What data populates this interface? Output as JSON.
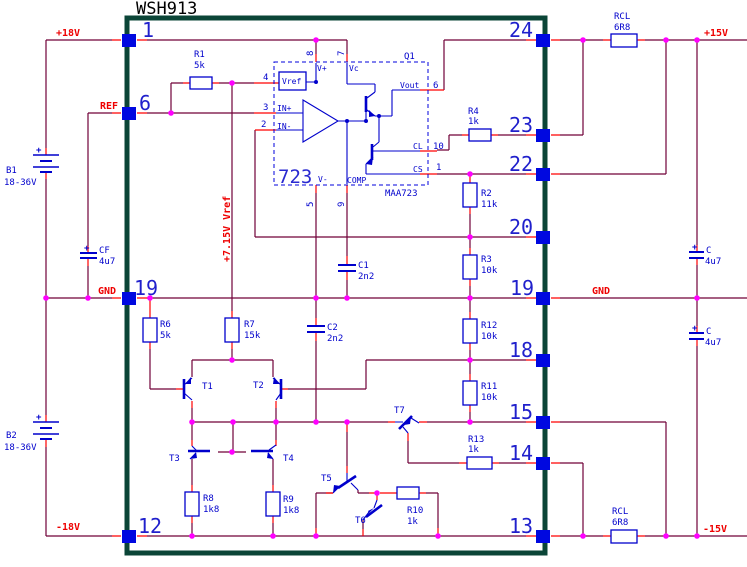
{
  "title": "WSH913",
  "module": {
    "pins_left": [
      "1",
      "6",
      "19",
      "12"
    ],
    "pins_right": [
      "24",
      "23",
      "22",
      "20",
      "19",
      "18",
      "15",
      "14",
      "13"
    ]
  },
  "power": {
    "p18": "+18V",
    "m18": "-18V",
    "p15": "+15V",
    "m15": "-15V",
    "gnd_left": "GND",
    "gnd_right": "GND",
    "ref": "REF",
    "vref_rail": "+7.15V Vref"
  },
  "sources": {
    "b1": {
      "name": "B1",
      "value": "18-36V",
      "plus": "+"
    },
    "b2": {
      "name": "B2",
      "value": "18-36V",
      "plus": "+"
    }
  },
  "ic": {
    "big": "723",
    "part": "MAA723",
    "designator": "Q1",
    "vref_block": "Vref",
    "names": {
      "vplus": "V+",
      "vc": "Vc",
      "vout": "Vout",
      "cl": "CL",
      "cs": "CS",
      "vminus": "V-",
      "comp": "COMP",
      "inplus": "IN+",
      "inminus": "IN-"
    },
    "numbers": {
      "n8": "8",
      "n7": "7",
      "n4": "4",
      "n3": "3",
      "n2": "2",
      "n6": "6",
      "n10": "10",
      "n1": "1",
      "n5": "5",
      "n9": "9"
    }
  },
  "resistors": {
    "r1": {
      "name": "R1",
      "value": "5k"
    },
    "r2": {
      "name": "R2",
      "value": "11k"
    },
    "r3": {
      "name": "R3",
      "value": "10k"
    },
    "r4": {
      "name": "R4",
      "value": "1k"
    },
    "r6": {
      "name": "R6",
      "value": "5k"
    },
    "r7": {
      "name": "R7",
      "value": "15k"
    },
    "r8": {
      "name": "R8",
      "value": "1k8"
    },
    "r9": {
      "name": "R9",
      "value": "1k8"
    },
    "r10": {
      "name": "R10",
      "value": "1k"
    },
    "r11": {
      "name": "R11",
      "value": "10k"
    },
    "r12": {
      "name": "R12",
      "value": "10k"
    },
    "r13": {
      "name": "R13",
      "value": "1k"
    },
    "rcl_top": {
      "name": "RCL",
      "value": "6R8"
    },
    "rcl_bot": {
      "name": "RCL",
      "value": "6R8"
    }
  },
  "capacitors": {
    "c1": {
      "name": "C1",
      "value": "2n2"
    },
    "c2": {
      "name": "C2",
      "value": "2n2"
    },
    "cf": {
      "name": "CF",
      "value": "4u7",
      "plus": "+"
    },
    "c_top": {
      "name": "C",
      "value": "4u7",
      "plus": "+"
    },
    "c_bot": {
      "name": "C",
      "value": "4u7",
      "plus": "+"
    }
  },
  "transistors": {
    "t1": "T1",
    "t2": "T2",
    "t3": "T3",
    "t4": "T4",
    "t5": "T5",
    "t6": "T6",
    "t7": "T7"
  },
  "colors": {
    "wire": "#700038",
    "pin_stub": "#ff0000",
    "junction": "#ff00ff",
    "component_blue": "#0000cc",
    "module_border": "#0b4537",
    "net_label_red": "#ee0000",
    "pin_square": "#0008e0",
    "background": "#ffffff"
  }
}
